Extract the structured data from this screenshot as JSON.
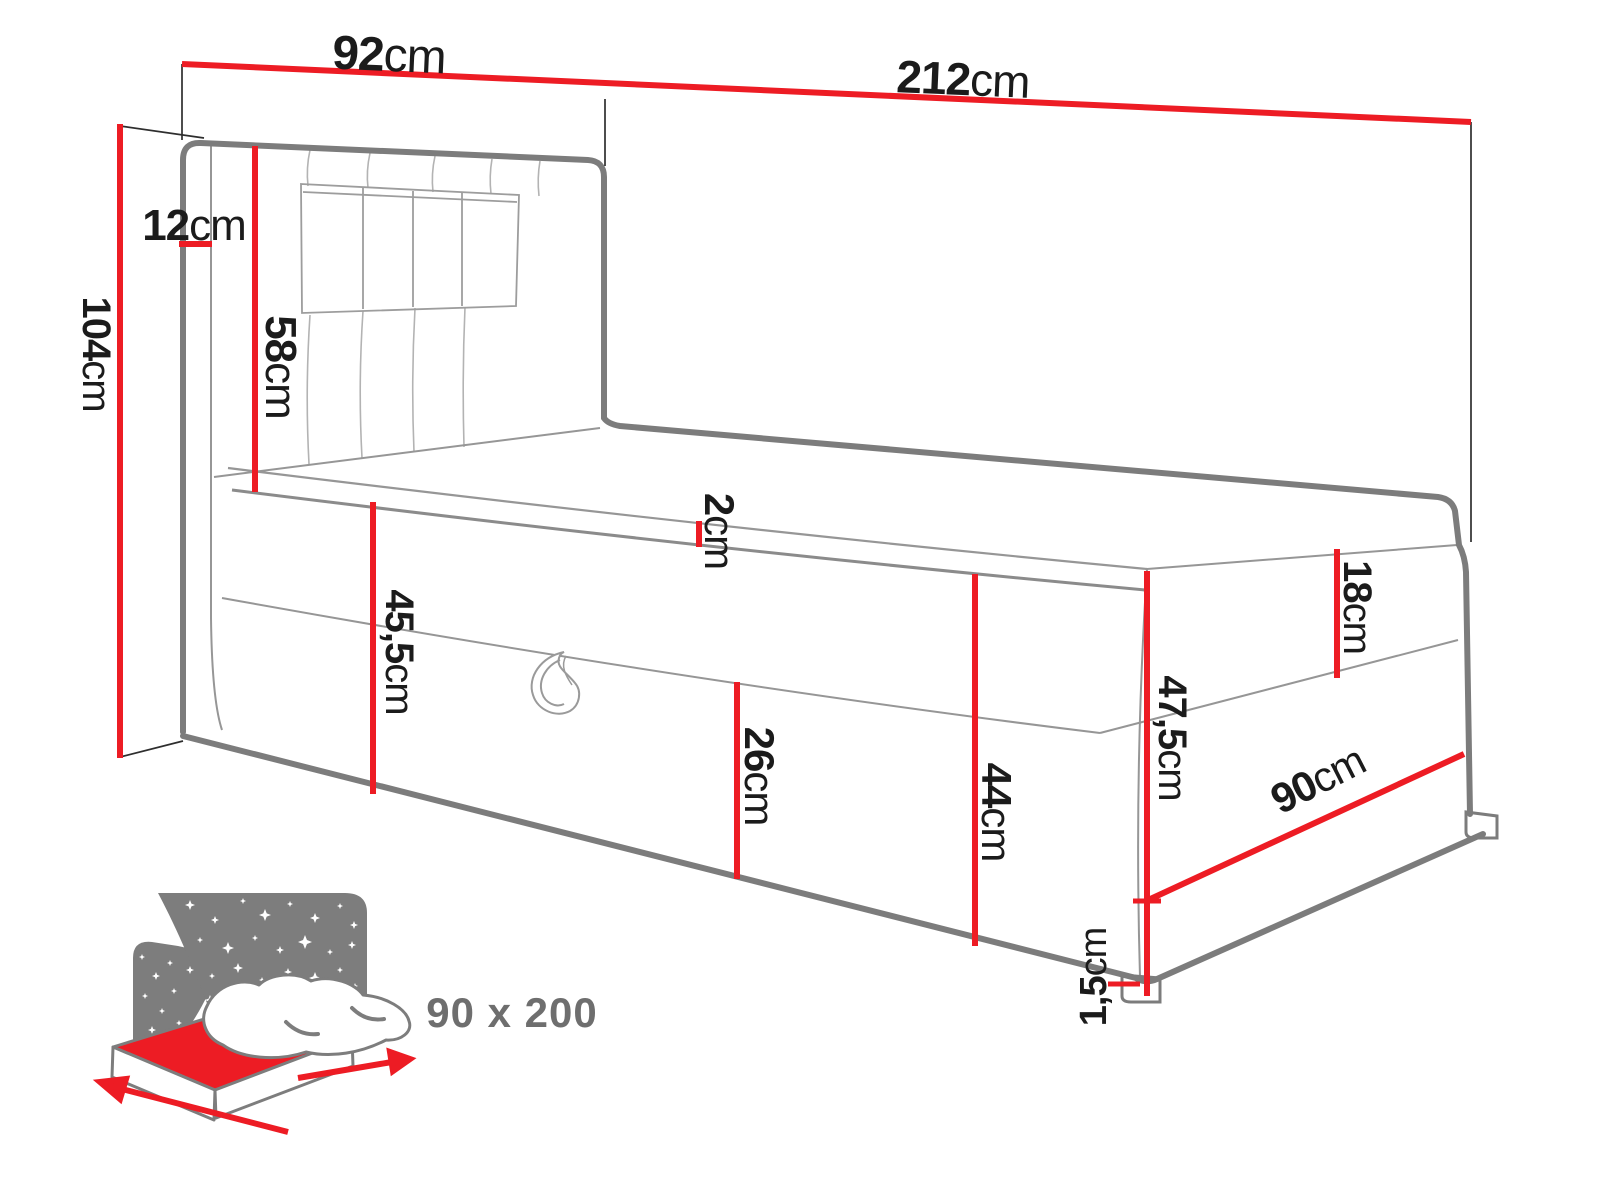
{
  "diagram": {
    "type": "bed-dimension-technical-drawing",
    "accent_color": "#ed1c24",
    "outline_color": "#7c7c7c",
    "text_color": "#1b1b1b",
    "icon_color": "#7d7d7d",
    "mattress_size_label": "90 x 200",
    "dimensions": {
      "headboard_width": {
        "value": "92",
        "unit": "cm"
      },
      "total_length": {
        "value": "212",
        "unit": "cm"
      },
      "headboard_depth": {
        "value": "12",
        "unit": "cm"
      },
      "headboard_above_mattress": {
        "value": "58",
        "unit": "cm"
      },
      "total_height": {
        "value": "104",
        "unit": "cm"
      },
      "side_height_head": {
        "value": "45,5",
        "unit": "cm"
      },
      "topper_thickness": {
        "value": "2",
        "unit": "cm"
      },
      "storage_box_height": {
        "value": "26",
        "unit": "cm"
      },
      "base_height_front": {
        "value": "44",
        "unit": "cm"
      },
      "top_box_height": {
        "value": "18",
        "unit": "cm"
      },
      "base_height_foot": {
        "value": "47,5",
        "unit": "cm"
      },
      "foot_width": {
        "value": "90",
        "unit": "cm"
      },
      "leg_height": {
        "value": "1,5",
        "unit": "cm"
      }
    }
  }
}
